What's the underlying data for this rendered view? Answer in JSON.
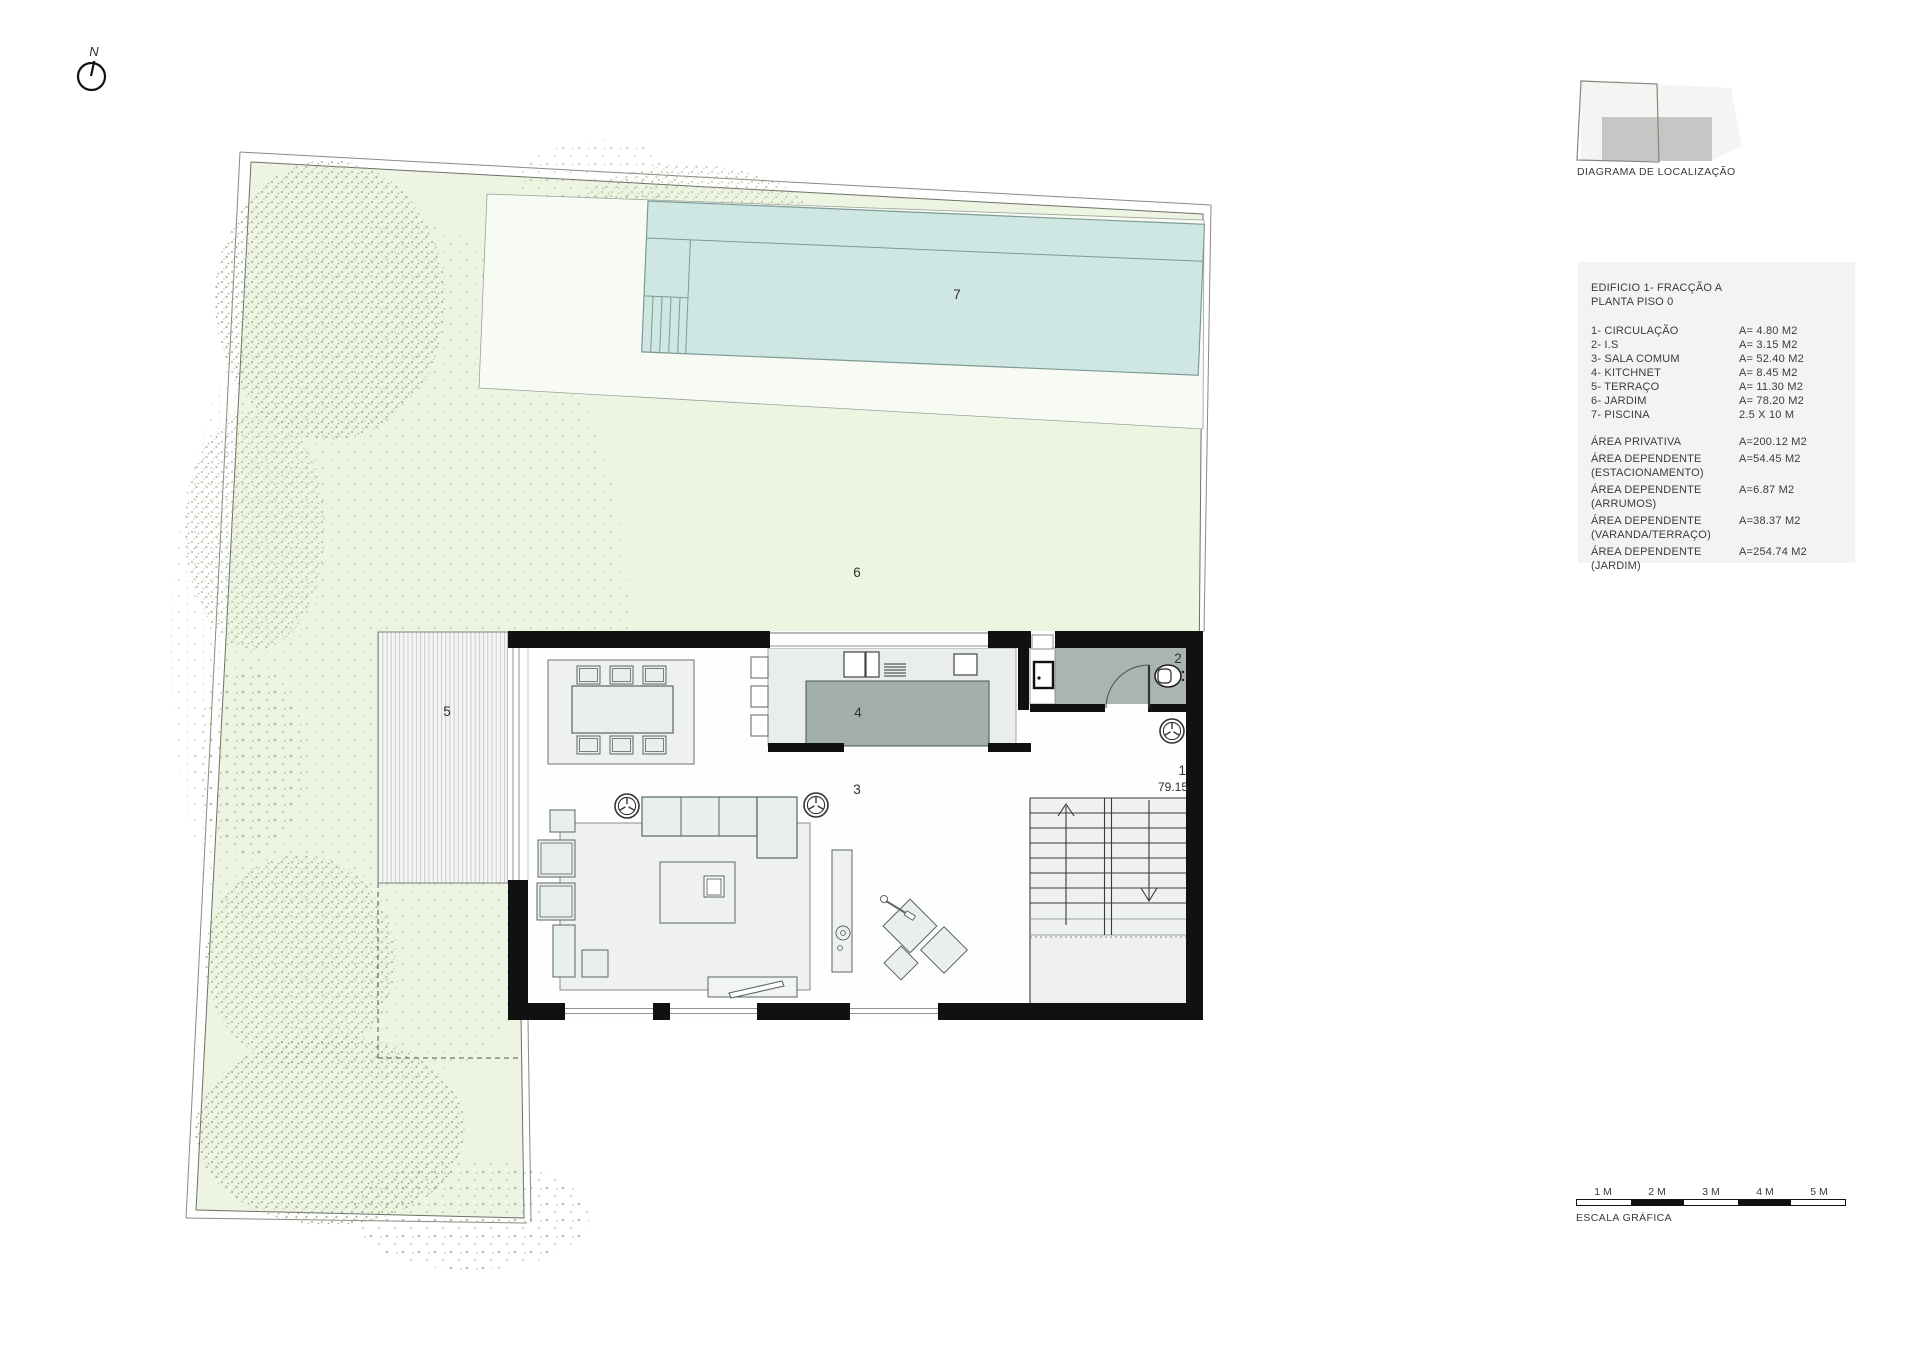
{
  "north_indicator": {
    "label": "N"
  },
  "location_diagram": {
    "caption": "DIAGRAMA DE LOCALIZAÇÃO"
  },
  "legend": {
    "title_line1": "EDIFICIO 1- FRACÇÃO A",
    "title_line2": "PLANTA PISO 0",
    "rooms": [
      {
        "label": "1- CIRCULAÇÃO",
        "area": "A= 4.80 M2"
      },
      {
        "label": "2- I.S",
        "area": "A= 3.15 M2"
      },
      {
        "label": "3- SALA COMUM",
        "area": "A= 52.40 M2"
      },
      {
        "label": "4- KITCHNET",
        "area": "A= 8.45 M2"
      },
      {
        "label": "5- TERRAÇO",
        "area": "A= 11.30 M2"
      },
      {
        "label": "6- JARDIM",
        "area": "A= 78.20 M2"
      },
      {
        "label": "7- PISCINA",
        "area": "2.5 X 10 M"
      }
    ],
    "areas": [
      {
        "line1": "ÁREA PRIVATIVA",
        "line2": "",
        "value": "A=200.12 M2"
      },
      {
        "line1": "ÁREA DEPENDENTE",
        "line2": "(ESTACIONAMENTO)",
        "value": "A=54.45 M2"
      },
      {
        "line1": "ÁREA DEPENDENTE",
        "line2": "(ARRUMOS)",
        "value": "A=6.87 M2"
      },
      {
        "line1": "ÁREA DEPENDENTE",
        "line2": "(VARANDA/TERRAÇO)",
        "value": "A=38.37 M2"
      },
      {
        "line1": "ÁREA DEPENDENTE",
        "line2": "(JARDIM)",
        "value": "A=254.74 M2"
      }
    ]
  },
  "plan_labels": {
    "circulation": "1",
    "bathroom": "2",
    "living_room": "3",
    "kitchen": "4",
    "terrace": "5",
    "garden": "6",
    "pool": "7",
    "level": "79.15"
  },
  "scale_bar": {
    "ticks": [
      "1 M",
      "2 M",
      "3 M",
      "4 M",
      "5 M"
    ],
    "caption": "ESCALA GRÁFICA"
  },
  "colors": {
    "garden_green": "#edf4e1",
    "pool_teal": "#cfe7e2",
    "deck_white": "#f8faf4",
    "wall_black": "#111111",
    "bathroom_gray": "#a9b5ae",
    "island_gray": "#a3b0a9",
    "kitchen_floor": "#e9edec",
    "furniture_fill": "#e9eeee",
    "furniture_line": "#5a6561",
    "legend_bg": "#f3f3f3",
    "diagram_building": "#c5c7c5",
    "text": "#3b3b3b"
  }
}
